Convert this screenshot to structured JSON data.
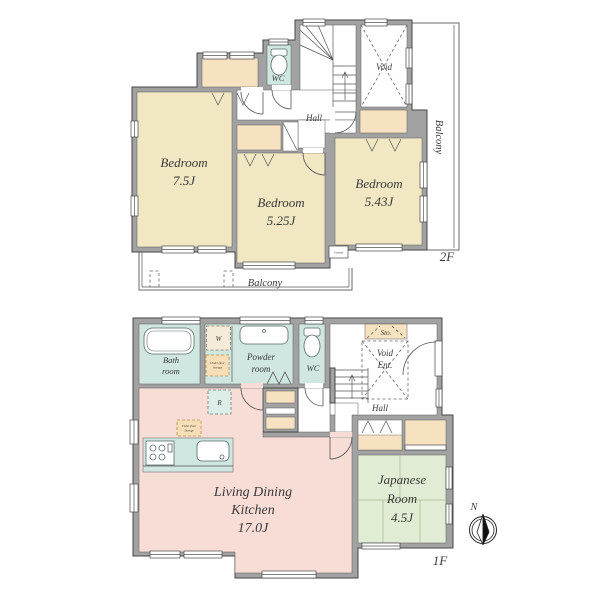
{
  "document": {
    "kind": "residential floor plan, 2 floors"
  },
  "colors": {
    "wall": "#a2a2a2",
    "bedroom_fill": "#f1e7c3",
    "closet_fill": "#f6e2c0",
    "wet_area_fill": "#cfe7e0",
    "ldk_fill": "#f8dcd6",
    "japanese_room_fill": "#e0ecd3",
    "storage_dash_fill": "#f6dfb6"
  },
  "floor_2f": {
    "label": "2F",
    "bedroom1_name": "Bedroom",
    "bedroom1_size": "7.5J",
    "bedroom2_name": "Bedroom",
    "bedroom2_size": "5.25J",
    "bedroom3_name": "Bedroom",
    "bedroom3_size": "5.43J",
    "wc": "WC",
    "hall": "Hall",
    "void": "Void",
    "balcony_bottom": "Balcony",
    "balcony_right": "Balcony",
    "counter": "Counter"
  },
  "floor_1f": {
    "label": "1F",
    "bath_line1": "Bath",
    "bath_line2": "room",
    "powder_line1": "Powder",
    "powder_line2": "room",
    "wc": "WC",
    "sto": "Sto.",
    "void": "Void",
    "ent": "Ent.",
    "hall": "Hall",
    "ldk_line1": "Living Dining",
    "ldk_line2": "Kitchen",
    "ldk_size": "17.0J",
    "japanese_line1": "Japanese",
    "japanese_line2": "Room",
    "japanese_size": "4.5J",
    "washer": "W",
    "fridge": "R",
    "underfloor_line1": "Under-floor",
    "underfloor_line2": "Storage",
    "compass_north": "N"
  }
}
